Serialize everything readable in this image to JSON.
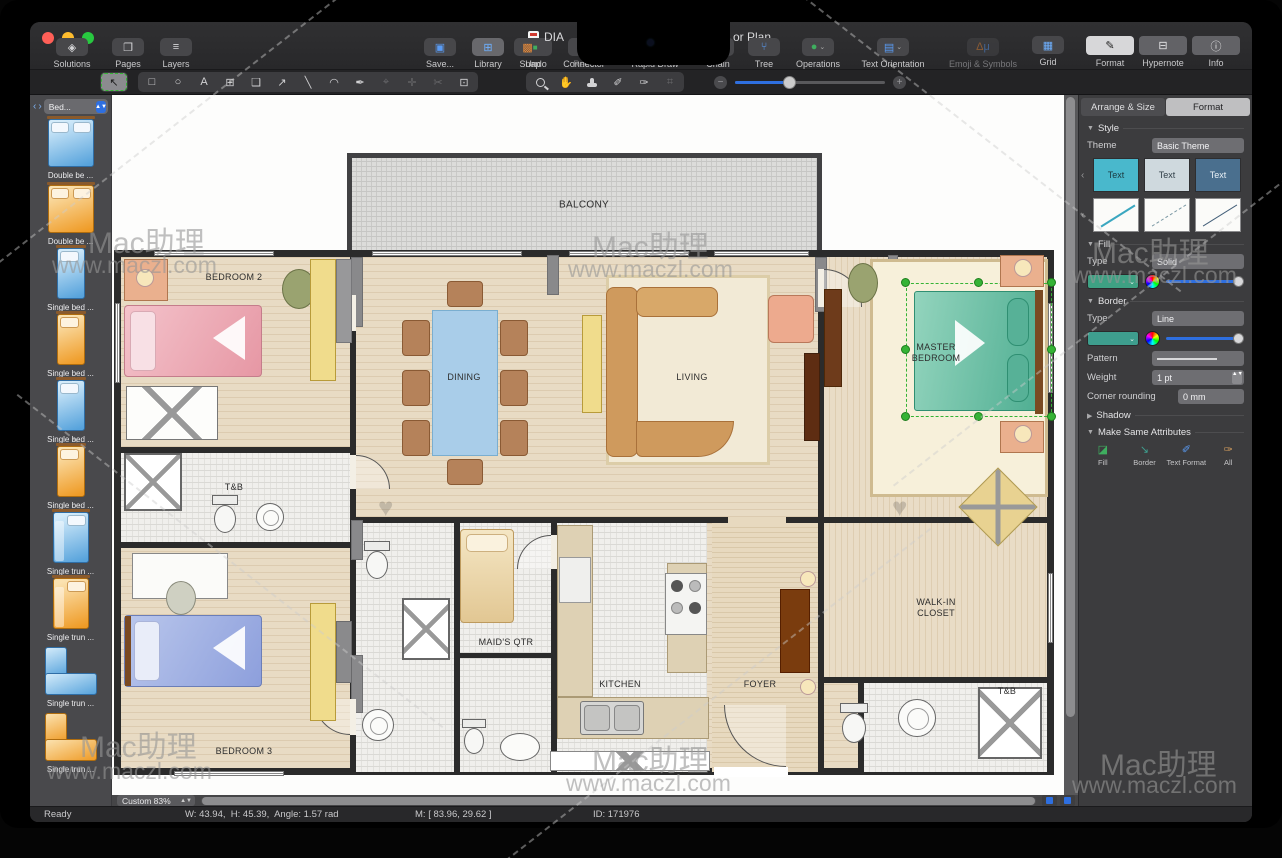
{
  "window": {
    "title_left": "DIA",
    "title_right": "or Plan",
    "traffic_colors": [
      "#ff5f57",
      "#febc2e",
      "#28c840"
    ]
  },
  "toolbar": {
    "solutions": "Solutions",
    "pages": "Pages",
    "layers": "Layers",
    "save": "Save...",
    "library": "Library",
    "undo": "Undo",
    "redo": "Redo",
    "snap": "Snap",
    "connector": "Connector",
    "rapid_draw": "Rapid Draw",
    "chain": "Chain",
    "tree": "Tree",
    "operations": "Operations",
    "text_orientation": "Text Orientation",
    "emoji": "Emoji & Symbols",
    "grid": "Grid",
    "format": "Format",
    "hypernote": "Hypernote",
    "info": "Info"
  },
  "sidebar": {
    "dropdown": "Bed...",
    "items": [
      {
        "label": "Double be ...",
        "color": "blue"
      },
      {
        "label": "Double be ...",
        "color": "orange"
      },
      {
        "label": "Single bed ...",
        "color": "blue"
      },
      {
        "label": "Single bed ...",
        "color": "orange"
      },
      {
        "label": "Single bed ...",
        "color": "blue"
      },
      {
        "label": "Single bed ...",
        "color": "orange"
      },
      {
        "label": "Single trun ...",
        "color": "blue"
      },
      {
        "label": "Single trun ...",
        "color": "orange"
      },
      {
        "label": "Single trun ...",
        "color": "blue"
      },
      {
        "label": "Single trun ...",
        "color": "orange"
      }
    ]
  },
  "panel": {
    "tabs": {
      "arrange": "Arrange & Size",
      "format": "Format"
    },
    "style": {
      "title": "Style",
      "theme_label": "Theme",
      "theme_value": "Basic Theme",
      "swatch_text": "Text"
    },
    "fill": {
      "title": "Fill",
      "type_label": "Type",
      "type_value": "Solid"
    },
    "border": {
      "title": "Border",
      "type_label": "Type",
      "type_value": "Line",
      "pattern_label": "Pattern",
      "weight_label": "Weight",
      "weight_value": "1 pt",
      "corner_label": "Corner rounding",
      "corner_value": "0 mm"
    },
    "shadow": {
      "title": "Shadow"
    },
    "same": {
      "title": "Make Same Attributes",
      "fill": "Fill",
      "border": "Border",
      "text_format": "Text Format",
      "all": "All"
    }
  },
  "plan": {
    "rooms": {
      "balcony": "BALCONY",
      "bedroom2": "BEDROOM 2",
      "dining": "DINING",
      "living": "LIVING",
      "master": "MASTER BEDROOM",
      "tb_upper": "T&B",
      "maid": "MAID'S QTR",
      "kitchen": "KITCHEN",
      "foyer": "FOYER",
      "closet": "WALK-IN CLOSET",
      "tb_lower": "T&B",
      "bedroom3": "BEDROOM 3"
    }
  },
  "statusbar": {
    "ready": "Ready",
    "dims": "W: 43.94,  H: 45.39,  Angle: 1.57 rad",
    "coords": "M: [ 83.96, 29.62 ]",
    "id": "ID: 171976",
    "zoom": "Custom 83%"
  },
  "watermark": {
    "brand": "Mac助理",
    "url": "www.maczl.com"
  },
  "colors": {
    "accent_blue": "#2e6fe0",
    "fill_green": "#3ea183",
    "border_teal": "#3e9e8e",
    "selection_green": "#35b335",
    "swatch_teal": "#49b8cc",
    "swatch_light": "#cfd9de",
    "swatch_dark": "#4a6f8e"
  }
}
